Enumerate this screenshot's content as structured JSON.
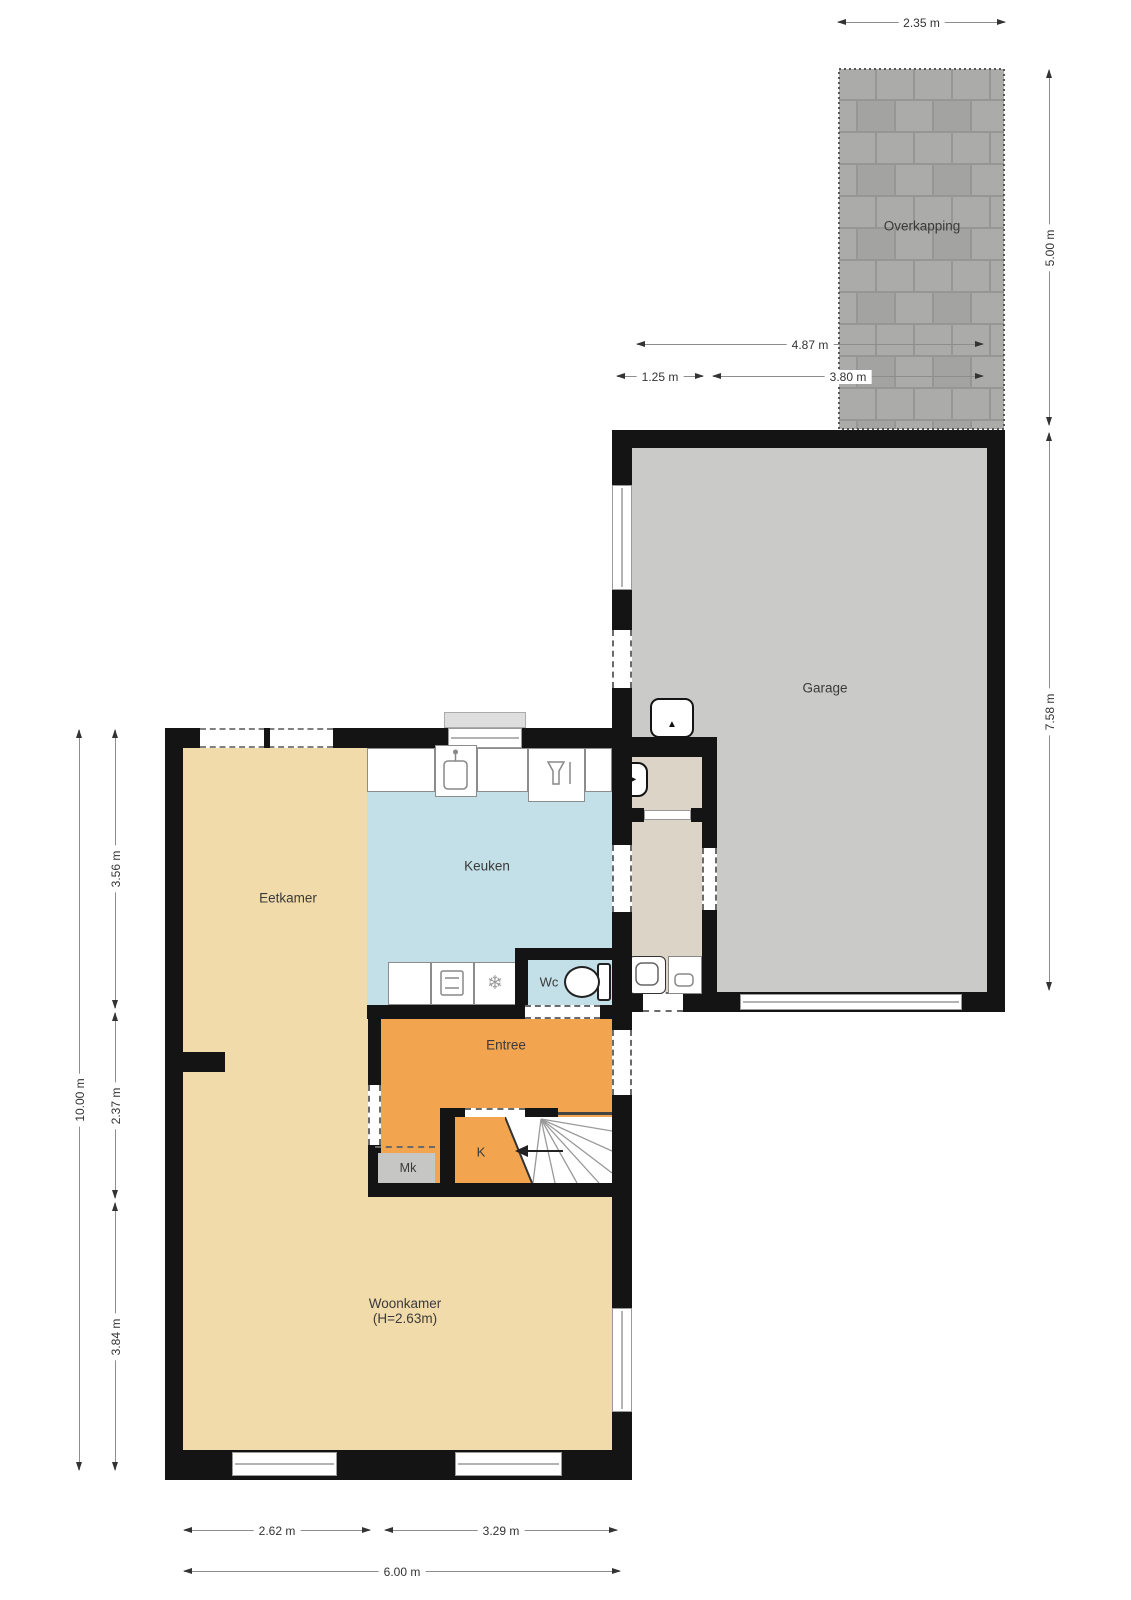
{
  "rooms": {
    "overkapping": "Overkapping",
    "garage": "Garage",
    "eetkamer": "Eetkamer",
    "keuken": "Keuken",
    "wc": "Wc",
    "entree": "Entree",
    "kast": "K",
    "meterkast": "Mk",
    "woonkamer": "Woonkamer",
    "woonkamer_height": "(H=2.63m)"
  },
  "dims": {
    "overkapping_width": "2.35 m",
    "overkapping_depth": "5.00 m",
    "garage_depth": "7.58 m",
    "garage_outer_width": "4.87 m",
    "berging_width": "1.25 m",
    "garage_inner_width": "3.80 m",
    "house_depth_total": "10.00 m",
    "house_depth_top": "3.56 m",
    "house_depth_mid": "2.37 m",
    "house_depth_bottom": "3.84 m",
    "house_width_left": "2.62 m",
    "house_width_right": "3.29 m",
    "house_width_total": "6.00 m"
  },
  "icons": {
    "hob_freezer": "❄",
    "door_swing_right": "▶",
    "door_swing_up": "▲"
  },
  "colors": {
    "wall": "#141414",
    "floor_living": "#F1DBAA",
    "floor_kitchen": "#C3DFE7",
    "floor_entree": "#F2A44F",
    "floor_utility": "#DCD4C6",
    "floor_meterkast": "#C6C6C4",
    "floor_garage": "#CACBC9",
    "paving": "#ABABA9"
  }
}
